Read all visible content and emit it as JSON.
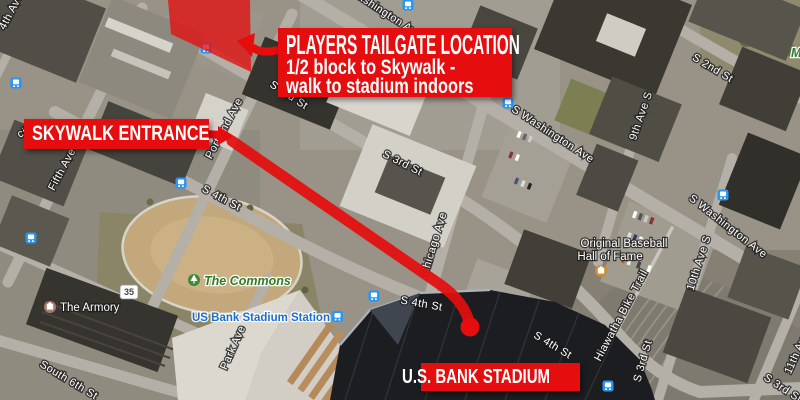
{
  "annotations": {
    "accent_color": "#e50d0d",
    "tailgate_box": {
      "title": "PLAYERS TAILGATE LOCATION",
      "subtitle_line1": "1/2 block to Skywalk -",
      "subtitle_line2": "walk to stadium indoors"
    },
    "skywalk_box": {
      "label": "SKYWALK ENTRANCE"
    },
    "stadium_box": {
      "label": "U.S. BANK STADIUM"
    }
  },
  "map": {
    "colors": {
      "transit_blue": "#2795f2",
      "park_label_green": "#2f7d2a",
      "station_label_blue": "#1a6fd0",
      "annotation_red": "#e50d0d"
    },
    "route_shield": {
      "text": "35"
    },
    "street_labels": [
      {
        "text": "Washington Av",
        "x": 381,
        "y": 14,
        "r": 33
      },
      {
        "text": "S 2nd St",
        "x": 711,
        "y": 71,
        "r": 31
      },
      {
        "text": "S Washington Ave",
        "x": 551,
        "y": 137,
        "r": 33
      },
      {
        "text": "S Washington Ave",
        "x": 726,
        "y": 229,
        "r": 38
      },
      {
        "text": "9th Ave S",
        "x": 644,
        "y": 117,
        "r": -71
      },
      {
        "text": "10th Ave S",
        "x": 702,
        "y": 264,
        "r": -72
      },
      {
        "text": "11th Ave S",
        "x": 802,
        "y": 349,
        "r": -66
      },
      {
        "text": "S 3rd St",
        "x": 287,
        "y": 98,
        "r": 33
      },
      {
        "text": "S 3rd St",
        "x": 401,
        "y": 166,
        "r": 27
      },
      {
        "text": "S 3rd St",
        "x": 646,
        "y": 362,
        "r": -74
      },
      {
        "text": "S 3rd St",
        "x": 781,
        "y": 391,
        "r": 33
      },
      {
        "text": "Hiawatha Bike Trail",
        "x": 624,
        "y": 317,
        "r": -62
      },
      {
        "text": "Chicago Ave",
        "x": 437,
        "y": 245,
        "r": -73
      },
      {
        "text": "Portland Ave",
        "x": 227,
        "y": 130,
        "r": -62
      },
      {
        "text": "Fifth Ave",
        "x": 65,
        "y": 171,
        "r": -62
      },
      {
        "text": "S 4th St",
        "x": 220,
        "y": 201,
        "r": 28
      },
      {
        "text": "S 4th St",
        "x": 421,
        "y": 307,
        "r": 10
      },
      {
        "text": "S 4th St",
        "x": 551,
        "y": 348,
        "r": 31
      },
      {
        "text": "South 6th St",
        "x": 67,
        "y": 383,
        "r": 31
      },
      {
        "text": "Park Ave",
        "x": 236,
        "y": 349,
        "r": -66
      },
      {
        "text": "4th Ave",
        "x": 14,
        "y": 13,
        "r": -62
      },
      {
        "text": "cility",
        "x": 30,
        "y": 133,
        "r": -25
      }
    ],
    "poi": {
      "commons": "The Commons",
      "station": "US Bank Stadium Station",
      "armory": "The Armory",
      "hof_line1": "Original Baseball",
      "hof_line2": "Hall of Fame",
      "partial_park_label": "M"
    },
    "transit_icons": [
      [
        206,
        48
      ],
      [
        408,
        5
      ],
      [
        508,
        103
      ],
      [
        723,
        195
      ],
      [
        16,
        83
      ],
      [
        31,
        238
      ],
      [
        181,
        183
      ],
      [
        374,
        296
      ],
      [
        608,
        386
      ]
    ]
  }
}
